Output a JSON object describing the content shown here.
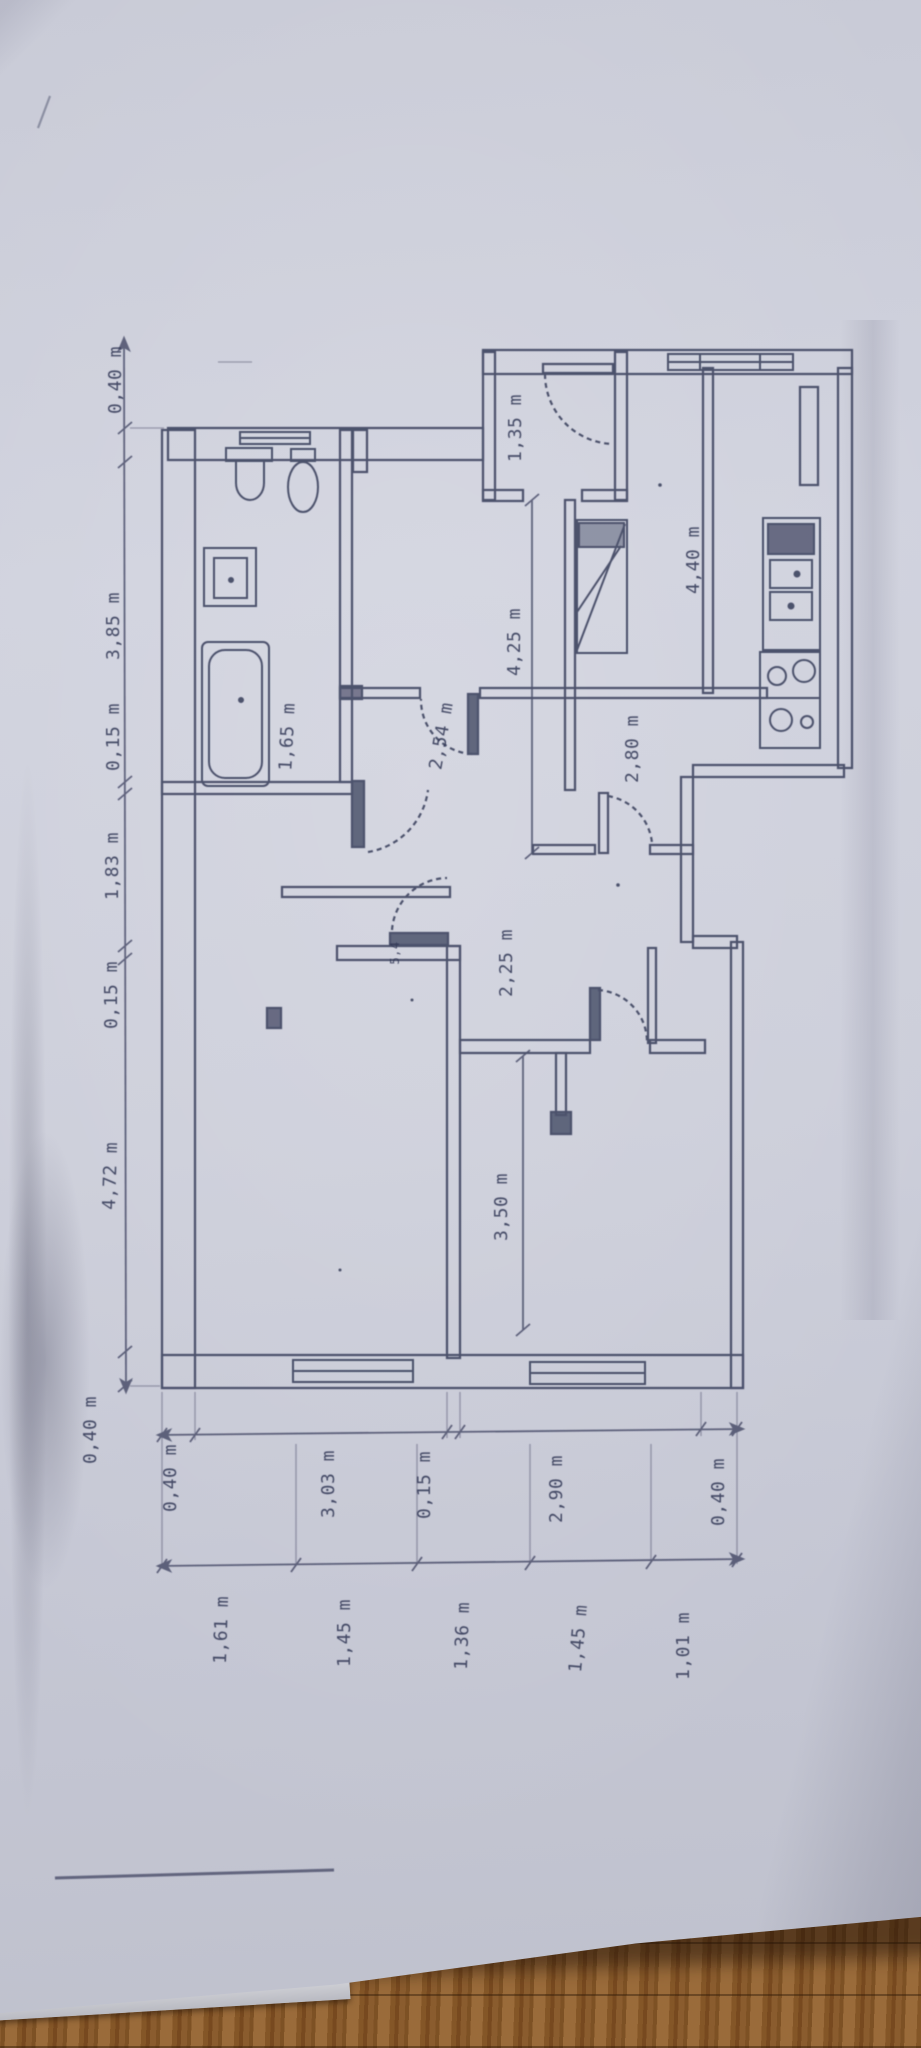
{
  "meta": {
    "description": "Photograph of a hand-drafted apartment floor plan on paper lying on a wooden floor; plan is rotated 90 degrees so all dimension text reads bottom-up",
    "unit": "m"
  },
  "colors": {
    "paper": "#cbcdd9",
    "ink": "#2c3150",
    "wood": "#8a5c2e"
  },
  "dimension_chains": {
    "left": [
      "0,40 m",
      "3,85 m",
      "0,15 m",
      "1,83 m",
      "0,15 m",
      "4,72 m",
      "0,40 m"
    ],
    "bottom_outer": [
      "0,40 m",
      "3,03 m",
      "0,15 m",
      "2,90 m",
      "0,40 m"
    ],
    "bottom_inner": [
      "1,61 m",
      "1,45 m",
      "1,36 m",
      "1,45 m",
      "1,01 m"
    ]
  },
  "room_dimensions": {
    "bathroom_width": "1,65 m",
    "bedroom2_width": "2,54 m",
    "living_span": "4,25 m",
    "hall_width": "2,80 m",
    "entry_width": "1,35 m",
    "kitchen_depth": "4,40 m",
    "hall_depth": "2,25 m",
    "bedroom3_depth": "3,50 m",
    "door_mark": "5,4"
  }
}
